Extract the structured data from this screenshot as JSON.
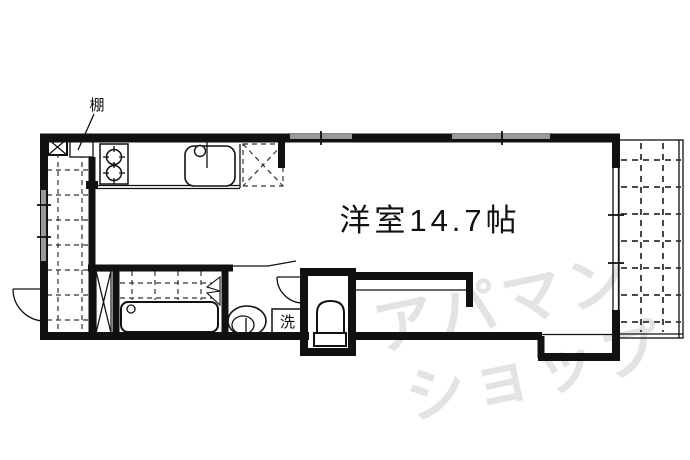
{
  "plan": {
    "room_label": "洋室14.7帖",
    "shelf_label": "棚",
    "washer_label": "洗",
    "watermark": {
      "line1": "アパマン",
      "line2": "ショップ"
    }
  },
  "colors": {
    "wall": "#111111",
    "ink": "#111111",
    "window": "#999999",
    "grid": "#333333",
    "watermark": "#e3e3e3",
    "paper": "#ffffff"
  }
}
